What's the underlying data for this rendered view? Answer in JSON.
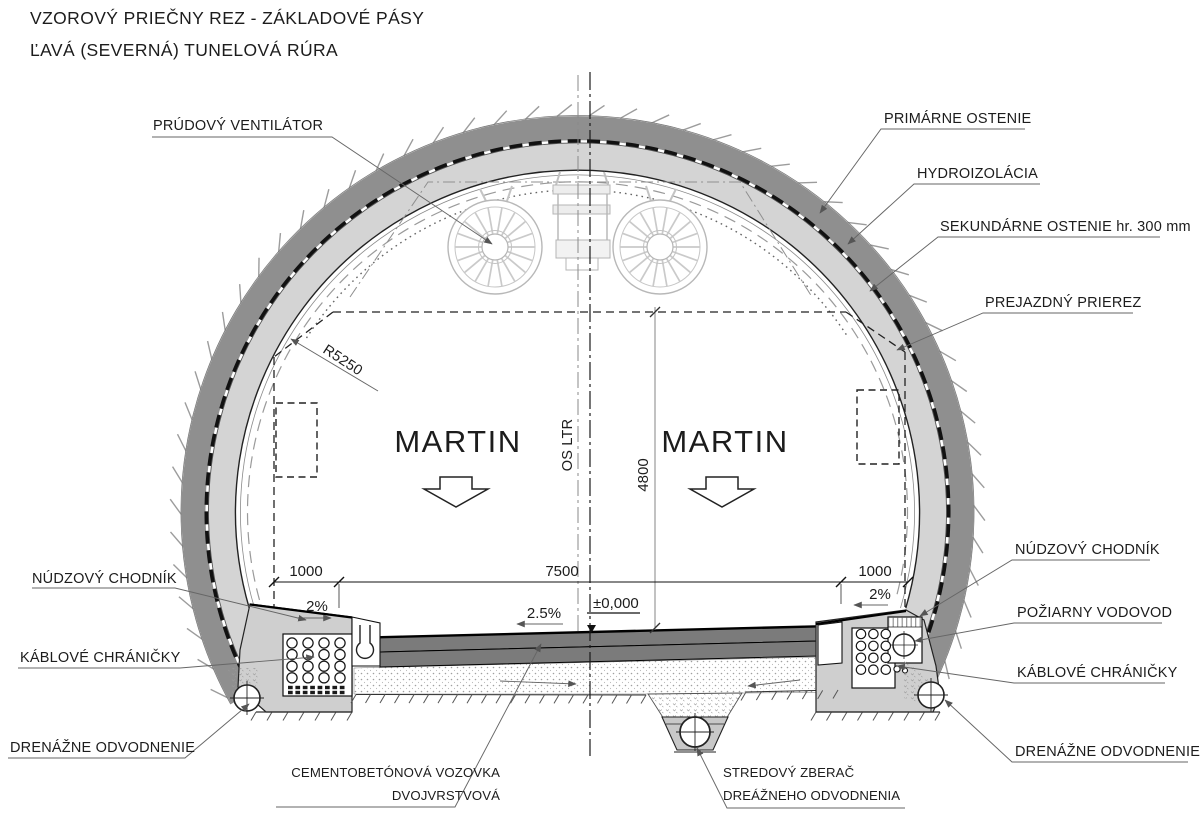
{
  "title": {
    "line1": "VZOROVÝ PRIEČNY REZ - ZÁKLADOVÉ PÁSY",
    "line2": "ĽAVÁ (SEVERNÁ) TUNELOVÁ RÚRA"
  },
  "callouts": {
    "jet_fan": "PRÚDOVÝ VENTILÁTOR",
    "primary_lining": "PRIMÁRNE OSTENIE",
    "waterproofing": "HYDROIZOLÁCIA",
    "secondary_lining": "SEKUNDÁRNE OSTENIE  hr. 300 mm",
    "clearance_profile": "PREJAZDNÝ PRIEREZ",
    "emergency_walkway": "NÚDZOVÝ CHODNÍK",
    "fire_water_main": "POŽIARNY VODOVOD",
    "cable_conduits": "KÁBLOVÉ CHRÁNIČKY",
    "drainage": "DRENÁŽNE ODVODNENIE",
    "pavement_line1": "CEMENTOBETÓNOVÁ VOZOVKA",
    "pavement_line2": "DVOJVRSTVOVÁ",
    "collector_line1": "STREDOVÝ ZBERAČ",
    "collector_line2": "DREÁŽNEHO ODVODNENIA"
  },
  "dimensions": {
    "walkway_left": "1000",
    "roadway": "7500",
    "walkway_right": "1000",
    "clearance_height": "4800",
    "inner_radius": "R5250",
    "level_mark": "±0,000",
    "slope_walkway_left": "2%",
    "slope_roadway": "2.5%",
    "slope_walkway_right": "2%",
    "tunnel_axis": "OS LTR"
  },
  "direction_sign": "MARTIN",
  "colors": {
    "primary_lining": "#8f8f8f",
    "secondary_lining": "#d4d4d4",
    "pavement": "#7b7b7b",
    "foundation": "#cfcfcf"
  }
}
